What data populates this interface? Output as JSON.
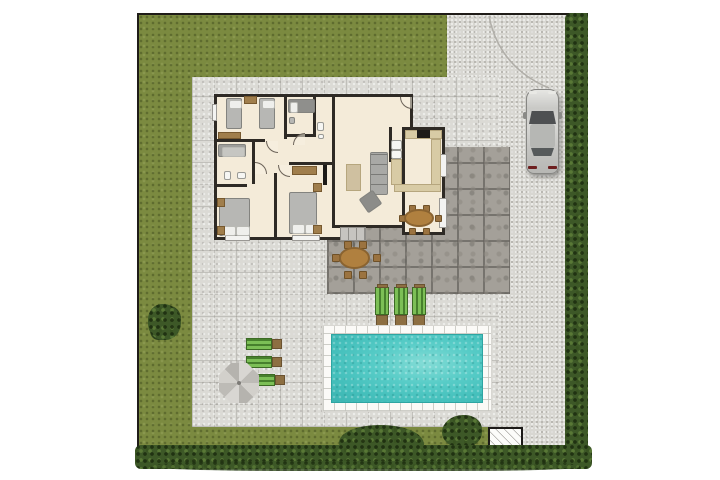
{
  "meta": {
    "title": "Villa plot site plan (top-down 2D render)",
    "visible_text": "none — the image contains no words, labels or numbers",
    "canvas": {
      "width": 720,
      "height": 480,
      "margin_color": "#ffffff"
    }
  },
  "palette": {
    "grass": "#7b8a40",
    "pavement_light": "#dbdad5",
    "driveway_speckle": "#d8d7d2",
    "patio_dark": "#a4a099",
    "hedge_green": "#3d5827",
    "house_floor": "#f4ebd9",
    "wall_dark": "#2e2a25",
    "pool_water": "#45c0bc",
    "pool_deck": "#fbfaf7",
    "lounger_green": "#7cbf56",
    "wood_brown": "#a07e4c",
    "table_brown": "#b0803f",
    "car_silver": "#c9c9c6",
    "parasol_grey": "#c9c7c2"
  },
  "elements": {
    "plot": {
      "label": "Fenced plot with black boundary line, hedge on right and bottom edges"
    },
    "garden": {
      "label": "Olive-green lawn on left, top-left and bottom strip",
      "shrub_left": 1,
      "bushes_bottom": 2
    },
    "driveway": {
      "label": "Speckled concrete driveway on right side with parked car and dashed gate arc",
      "cars": 1
    },
    "patio": {
      "label": "Dark grey tiled terrace behind the house with outdoor dining table",
      "outdoor_chairs": 6
    },
    "pool": {
      "label": "Rectangular turquoise swimming pool with white tiled deck",
      "loungers_beside_pool": 3
    },
    "relax_corner": {
      "label": "Three green sun loungers with grey parasol, lower left of paved court",
      "loungers": 3,
      "parasols": 1
    },
    "utility_box": {
      "label": "White hatched utility pad at bottom right"
    },
    "house": {
      "label": "Single-storey villa floor plan, cream floors and dark walls",
      "rooms": [
        {
          "name": "children-bedroom",
          "furniture": [
            "single-bed",
            "single-bed",
            "dresser",
            "sideboard"
          ]
        },
        {
          "name": "master-bedroom-top",
          "furniture": [
            "double-bed",
            "stool"
          ],
          "ensuite": [
            "toilet",
            "washbasin"
          ]
        },
        {
          "name": "bathroom",
          "furniture": [
            "bathtub",
            "toilet",
            "washbasin"
          ]
        },
        {
          "name": "bedroom-southwest",
          "furniture": [
            "double-bed",
            "nightstand",
            "nightstand"
          ]
        },
        {
          "name": "bedroom-south",
          "furniture": [
            "double-bed",
            "dresser",
            "nightstand",
            "nightstand"
          ]
        },
        {
          "name": "living-room",
          "furniture": [
            "sofa",
            "armchair",
            "coffee-table",
            "wall-tv"
          ]
        },
        {
          "name": "kitchen",
          "furniture": [
            "counter-l-shape",
            "stove",
            "dishwasher",
            "washing-machine",
            "sink-unit"
          ]
        },
        {
          "name": "dining-area",
          "furniture": [
            "oval-table",
            "chair",
            "chair",
            "chair",
            "chair",
            "chair",
            "chair"
          ]
        }
      ],
      "windows": 5,
      "doors_with_swing_arcs": 5,
      "terrace_steps": 1
    }
  }
}
